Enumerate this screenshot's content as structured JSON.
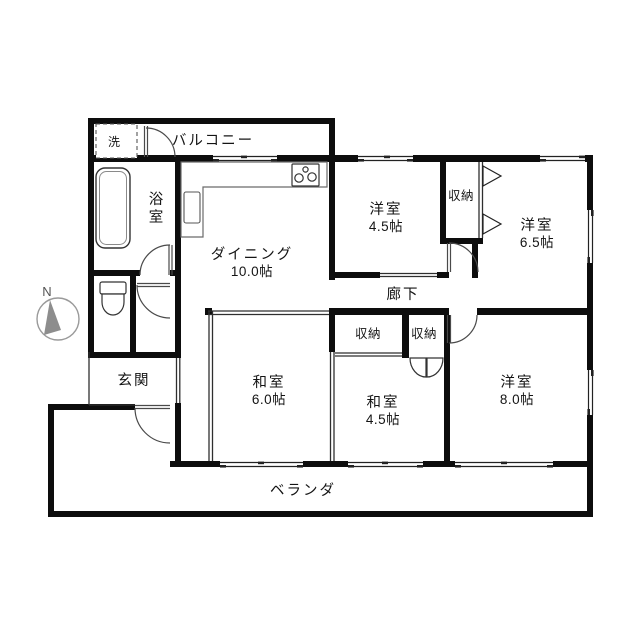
{
  "plan": {
    "rooms": {
      "balcony": {
        "label": "バルコニー"
      },
      "laundry": {
        "label": "洗"
      },
      "bath": {
        "label_char1": "浴",
        "label_char2": "室"
      },
      "dining": {
        "label": "ダイニング",
        "size": "10.0帖"
      },
      "western_45": {
        "label": "洋室",
        "size": "4.5帖"
      },
      "closet_top": {
        "label": "収納"
      },
      "western_65": {
        "label": "洋室",
        "size": "6.5帖"
      },
      "corridor": {
        "label": "廊下"
      },
      "closet_left": {
        "label": "収納"
      },
      "closet_right": {
        "label": "収納"
      },
      "japanese_60": {
        "label": "和室",
        "size": "6.0帖"
      },
      "japanese_45": {
        "label": "和室",
        "size": "4.5帖"
      },
      "western_80": {
        "label": "洋室",
        "size": "8.0帖"
      },
      "entrance": {
        "label": "玄関"
      },
      "veranda": {
        "label": "ベランダ"
      }
    },
    "compass": {
      "label": "N"
    },
    "icons": {
      "bathtub": "bathtub-icon",
      "kitchen_sink": "kitchen-sink-icon",
      "stove": "stove-burner-icon",
      "toilet": "toilet-icon",
      "washing_machine": "washing-machine-space-icon",
      "compass": "north-compass-icon"
    },
    "colors": {
      "wall": "#0d0d0d",
      "line": "#2f2f2f",
      "background": "#ffffff"
    }
  }
}
